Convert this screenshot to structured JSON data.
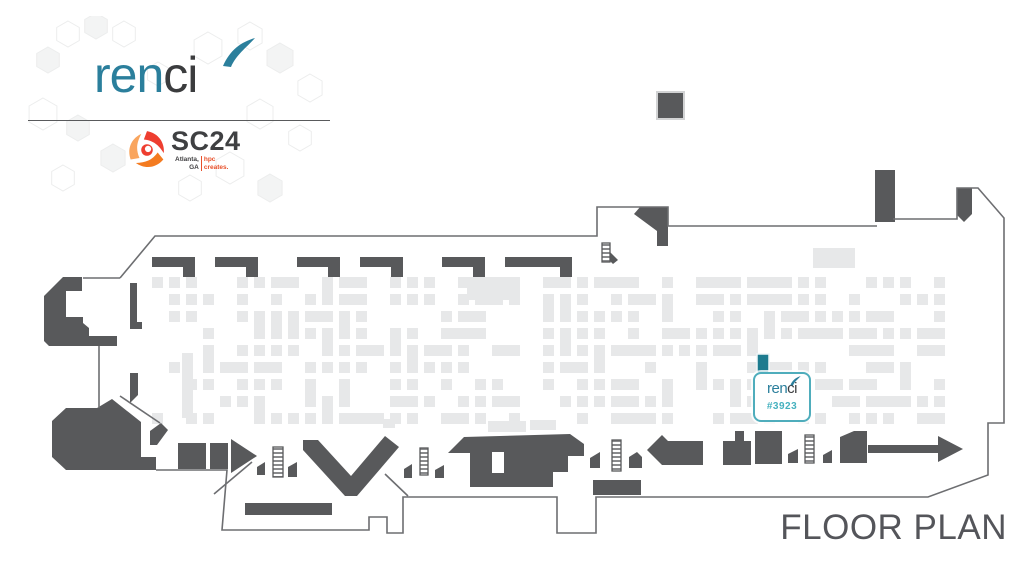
{
  "branding": {
    "renci": {
      "part_teal": "ren",
      "part_dark": "ci",
      "teal": "#2b7f9c",
      "dark": "#3b3c3e"
    },
    "sc24": {
      "title": "SC24",
      "tagline_left_top": "Atlanta,",
      "tagline_left_bottom": "GA",
      "tagline_right_top": "hpc",
      "tagline_right_bottom": "creates.",
      "orange": "#e8502a"
    }
  },
  "floor_plan": {
    "title": "FLOOR PLAN",
    "booth": {
      "vendor": "renci",
      "number": "#3923",
      "marker_fill": "#1d7b8f",
      "outline_color": "#4fadbc",
      "number_color": "#45b1bf"
    },
    "colors": {
      "structure": "#58595b",
      "wall": "#6d6e71",
      "booth_fill": "#e7e8e9"
    },
    "grid": {
      "x0": 152,
      "y0": 277,
      "cols": 47,
      "rows": 9,
      "pitch": 17,
      "cell": 11,
      "seed": 11,
      "skip": 0.28
    }
  }
}
